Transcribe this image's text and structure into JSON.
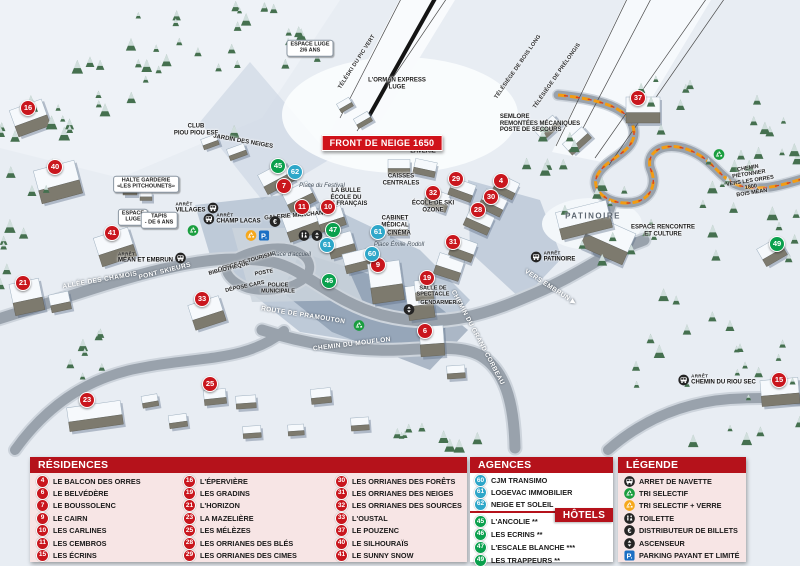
{
  "colors": {
    "marker_red": "#c9161d",
    "marker_blue": "#2ea7c9",
    "marker_green": "#0aa04d",
    "header_red": "#b5121b",
    "panel_pink": "#f7e5e5",
    "banner_red": "#d0121a",
    "parking_blue": "#1b6fc4"
  },
  "map": {
    "banner": "FRONT DE NEIGE 1650",
    "markers": [
      {
        "n": "16",
        "t": "res",
        "x": 28,
        "y": 108
      },
      {
        "n": "40",
        "t": "res",
        "x": 55,
        "y": 167
      },
      {
        "n": "41",
        "t": "res",
        "x": 112,
        "y": 233
      },
      {
        "n": "21",
        "t": "res",
        "x": 23,
        "y": 283
      },
      {
        "n": "33",
        "t": "res",
        "x": 202,
        "y": 299
      },
      {
        "n": "23",
        "t": "res",
        "x": 87,
        "y": 400
      },
      {
        "n": "25",
        "t": "res",
        "x": 210,
        "y": 384
      },
      {
        "n": "7",
        "t": "res",
        "x": 284,
        "y": 186
      },
      {
        "n": "11",
        "t": "res",
        "x": 302,
        "y": 207
      },
      {
        "n": "10",
        "t": "res",
        "x": 328,
        "y": 207
      },
      {
        "n": "9",
        "t": "res",
        "x": 378,
        "y": 265
      },
      {
        "n": "29",
        "t": "res",
        "x": 456,
        "y": 179
      },
      {
        "n": "32",
        "t": "res",
        "x": 433,
        "y": 193
      },
      {
        "n": "4",
        "t": "res",
        "x": 501,
        "y": 181
      },
      {
        "n": "30",
        "t": "res",
        "x": 491,
        "y": 197
      },
      {
        "n": "28",
        "t": "res",
        "x": 478,
        "y": 210
      },
      {
        "n": "31",
        "t": "res",
        "x": 453,
        "y": 242
      },
      {
        "n": "19",
        "t": "res",
        "x": 427,
        "y": 278
      },
      {
        "n": "6",
        "t": "res",
        "x": 425,
        "y": 331
      },
      {
        "n": "37",
        "t": "res",
        "x": 638,
        "y": 98
      },
      {
        "n": "15",
        "t": "res",
        "x": 779,
        "y": 380
      },
      {
        "n": "45",
        "t": "hot",
        "x": 278,
        "y": 166
      },
      {
        "n": "47",
        "t": "hot",
        "x": 333,
        "y": 230
      },
      {
        "n": "46",
        "t": "hot",
        "x": 329,
        "y": 281
      },
      {
        "n": "49",
        "t": "hot",
        "x": 777,
        "y": 244
      },
      {
        "n": "62",
        "t": "age",
        "x": 295,
        "y": 172
      },
      {
        "n": "61",
        "t": "age",
        "x": 327,
        "y": 245
      },
      {
        "n": "61",
        "t": "age",
        "x": 378,
        "y": 232
      },
      {
        "n": "60",
        "t": "age",
        "x": 372,
        "y": 254
      }
    ],
    "labels": [
      {
        "text": "TÉLÉSKI DU PIC VERT",
        "x": 357,
        "y": 62,
        "rot": -57,
        "cls": "lift"
      },
      {
        "text": "TÉLÉSIÈGE DE BOIS LONG",
        "x": 518,
        "y": 67,
        "rot": -55,
        "cls": "lift"
      },
      {
        "text": "TÉLÉSIÈGE DE PRÉLONGIS",
        "x": 557,
        "y": 76,
        "rot": -55,
        "cls": "lift"
      },
      {
        "text": "L'ORMAN EXPRESS\nLUGE",
        "x": 397,
        "y": 84,
        "cls": "place"
      },
      {
        "text": "SEMLORE\nREMONTÉES MÉCANIQUES\nPOSTE DE SECOURS",
        "x": 540,
        "y": 124,
        "cls": "place left"
      },
      {
        "text": "CLUB\nPIOU PIOU ESF",
        "x": 196,
        "y": 130,
        "cls": "place"
      },
      {
        "text": "JARDIN DES NEIGES",
        "x": 243,
        "y": 142,
        "rot": 10,
        "cls": "place"
      },
      {
        "text": "HALTE GARDERIE\n«LES PITCHOUNETS»",
        "x": 146,
        "y": 184,
        "cls": "box"
      },
      {
        "text": "LA BULLE\nÉCOLE DU\nSKI FRANÇAIS",
        "x": 346,
        "y": 198,
        "cls": "place"
      },
      {
        "text": "GALERIE MARCHANDE",
        "x": 298,
        "y": 216,
        "rot": -5,
        "cls": "place"
      },
      {
        "text": "CAISSES\nCENTRALES",
        "x": 401,
        "y": 180,
        "cls": "place"
      },
      {
        "text": "CABINET\nMÉDICAL",
        "x": 395,
        "y": 222,
        "cls": "place"
      },
      {
        "text": "CINÉMA",
        "x": 399,
        "y": 234,
        "cls": "place"
      },
      {
        "text": "ÉCOLE DE SKI\nOZONE",
        "x": 433,
        "y": 207,
        "cls": "place"
      },
      {
        "text": "LAVERIE",
        "x": 423,
        "y": 152,
        "cls": "place"
      },
      {
        "text": "OFFICE DE TOURISME",
        "x": 247,
        "y": 262,
        "rot": -16,
        "cls": "small"
      },
      {
        "text": "BIBLIOTHÈQUE",
        "x": 229,
        "y": 269,
        "rot": -14,
        "cls": "small"
      },
      {
        "text": "POSTE",
        "x": 264,
        "y": 273,
        "rot": -10,
        "cls": "small"
      },
      {
        "text": "DÉPOSE CARS",
        "x": 245,
        "y": 287,
        "rot": -12,
        "cls": "small"
      },
      {
        "text": "POLICE\nMUNICIPALE",
        "x": 278,
        "y": 289,
        "cls": "small"
      },
      {
        "text": "SALLE DE\nSPECTACLE",
        "x": 433,
        "y": 292,
        "cls": "small"
      },
      {
        "text": "GENDARMERIE",
        "x": 441,
        "y": 303,
        "cls": "small"
      },
      {
        "text": "PATINOIRE",
        "x": 593,
        "y": 216,
        "cls": "area"
      },
      {
        "text": "ESPACE RENCONTRE\nET CULTURE",
        "x": 663,
        "y": 231,
        "cls": "place"
      },
      {
        "text": "CHEMIN PIÉTONNIER\nVERS LES ORRES 1800\nBOIS MÉAN",
        "x": 750,
        "y": 181,
        "rot": -9,
        "cls": "small"
      },
      {
        "text": "Place du Festival",
        "x": 322,
        "y": 186,
        "cls": "italic"
      },
      {
        "text": "Place d'accueil",
        "x": 291,
        "y": 255,
        "cls": "italic"
      },
      {
        "text": "Place Émile Rodoll",
        "x": 399,
        "y": 245,
        "cls": "italic"
      },
      {
        "text": "ESPACE LUGE\n2/6 ANS",
        "x": 310,
        "y": 48,
        "cls": "box"
      },
      {
        "text": "ESPACE\nLUGE",
        "x": 133,
        "y": 217,
        "cls": "box"
      },
      {
        "text": "TAPIS\n- DE 6 ANS",
        "x": 159,
        "y": 220,
        "cls": "box"
      },
      {
        "text": "ALLÉE DES CHAMOIS",
        "x": 100,
        "y": 281,
        "rot": -10,
        "cls": "road"
      },
      {
        "text": "PONT SKIEURS",
        "x": 165,
        "y": 272,
        "rot": -14,
        "cls": "road"
      },
      {
        "text": "ROUTE DE PRAMOUTON",
        "x": 303,
        "y": 316,
        "rot": 9,
        "cls": "road"
      },
      {
        "text": "CHEMIN DU MOUFLON",
        "x": 352,
        "y": 345,
        "rot": -7,
        "cls": "road"
      },
      {
        "text": "CHEMIN DU GRAND CORBEAU",
        "x": 477,
        "y": 338,
        "rot": 62,
        "cls": "road"
      },
      {
        "text": "VERS EMBRUN ▶",
        "x": 550,
        "y": 288,
        "rot": 33,
        "cls": "road"
      }
    ],
    "bus_stops": [
      {
        "prefix": "ARRÊT",
        "name": "VILLAGES",
        "x": 197,
        "y": 208,
        "iconRight": true
      },
      {
        "prefix": "ARRÊT",
        "name": "CHAMP LACAS",
        "x": 232,
        "y": 219
      },
      {
        "prefix": "ARRÊT",
        "name": "MÉAN ET EMBRUN",
        "x": 152,
        "y": 258,
        "iconRight": true
      },
      {
        "prefix": "ARRÊT",
        "name": "PATINOIRE",
        "x": 553,
        "y": 257
      },
      {
        "prefix": "ARRÊT",
        "name": "CHEMIN DU RIOU SEC",
        "x": 717,
        "y": 380
      }
    ],
    "poi_icons": [
      {
        "icon": "euro",
        "x": 275,
        "y": 223
      },
      {
        "icon": "parking",
        "x": 264,
        "y": 237
      },
      {
        "icon": "recycle-verre",
        "x": 251,
        "y": 237
      },
      {
        "icon": "toilette",
        "x": 304,
        "y": 237
      },
      {
        "icon": "ascenseur",
        "x": 317,
        "y": 237
      },
      {
        "icon": "ascenseur",
        "x": 409,
        "y": 311
      },
      {
        "icon": "recycle",
        "x": 193,
        "y": 232
      },
      {
        "icon": "recycle",
        "x": 359,
        "y": 327
      },
      {
        "icon": "recycle",
        "x": 719,
        "y": 156
      }
    ]
  },
  "legend": {
    "residences": {
      "title": "RÉSIDENCES",
      "columns": [
        [
          {
            "n": "4",
            "name": "LE BALCON DES ORRES"
          },
          {
            "n": "6",
            "name": "LE BELVÉDÈRE"
          },
          {
            "n": "7",
            "name": "LE BOUSSOLENC"
          },
          {
            "n": "9",
            "name": "LE CAIRN"
          },
          {
            "n": "10",
            "name": "LES CARLINES"
          },
          {
            "n": "11",
            "name": "LES CEMBROS"
          },
          {
            "n": "15",
            "name": "LES ÉCRINS"
          }
        ],
        [
          {
            "n": "16",
            "name": "L'ÉPERVIÈRE"
          },
          {
            "n": "19",
            "name": "LES GRADINS"
          },
          {
            "n": "21",
            "name": "L'HORIZON"
          },
          {
            "n": "23",
            "name": "LA MAZELIÈRE"
          },
          {
            "n": "25",
            "name": "LES MÉLÈZES"
          },
          {
            "n": "28",
            "name": "LES ORRIANES DES BLÉS"
          },
          {
            "n": "29",
            "name": "LES ORRIANES DES CIMES"
          }
        ],
        [
          {
            "n": "30",
            "name": "LES ORRIANES DES FORÊTS"
          },
          {
            "n": "31",
            "name": "LES ORRIANES DES NEIGES"
          },
          {
            "n": "32",
            "name": "LES ORRIANES DES SOURCES"
          },
          {
            "n": "33",
            "name": "L'OUSTAL"
          },
          {
            "n": "37",
            "name": "LE POUZENC"
          },
          {
            "n": "40",
            "name": "LE SILHOURAÏS"
          },
          {
            "n": "41",
            "name": "LE SUNNY SNOW"
          }
        ]
      ]
    },
    "agences": {
      "title": "AGENCES IMMOBILIÈRES",
      "items": [
        {
          "n": "60",
          "name": "CJM TRANSIMO"
        },
        {
          "n": "61",
          "name": "LOGEVAC IMMOBILIER"
        },
        {
          "n": "62",
          "name": "NEIGE ET SOLEIL"
        }
      ]
    },
    "hotels": {
      "title": "HÔTELS",
      "items": [
        {
          "n": "45",
          "name": "L'ANCOLIE **"
        },
        {
          "n": "46",
          "name": "LES ECRINS **"
        },
        {
          "n": "47",
          "name": "L'ESCALE BLANCHE ***"
        },
        {
          "n": "49",
          "name": "LES TRAPPEURS **"
        }
      ]
    },
    "legende": {
      "title": "LÉGENDE",
      "items": [
        {
          "icon": "bus",
          "label": "ARRET DE NAVETTE"
        },
        {
          "icon": "recycle",
          "label": "TRI SELECTIF"
        },
        {
          "icon": "recycle-verre",
          "label": "TRI SELECTIF + VERRE"
        },
        {
          "icon": "toilette",
          "label": "TOILETTE"
        },
        {
          "icon": "euro",
          "label": "DISTRIBUTEUR DE BILLETS"
        },
        {
          "icon": "ascenseur",
          "label": "ASCENSEUR"
        },
        {
          "icon": "parking",
          "label": "PARKING PAYANT ET LIMITÉ"
        }
      ]
    }
  }
}
